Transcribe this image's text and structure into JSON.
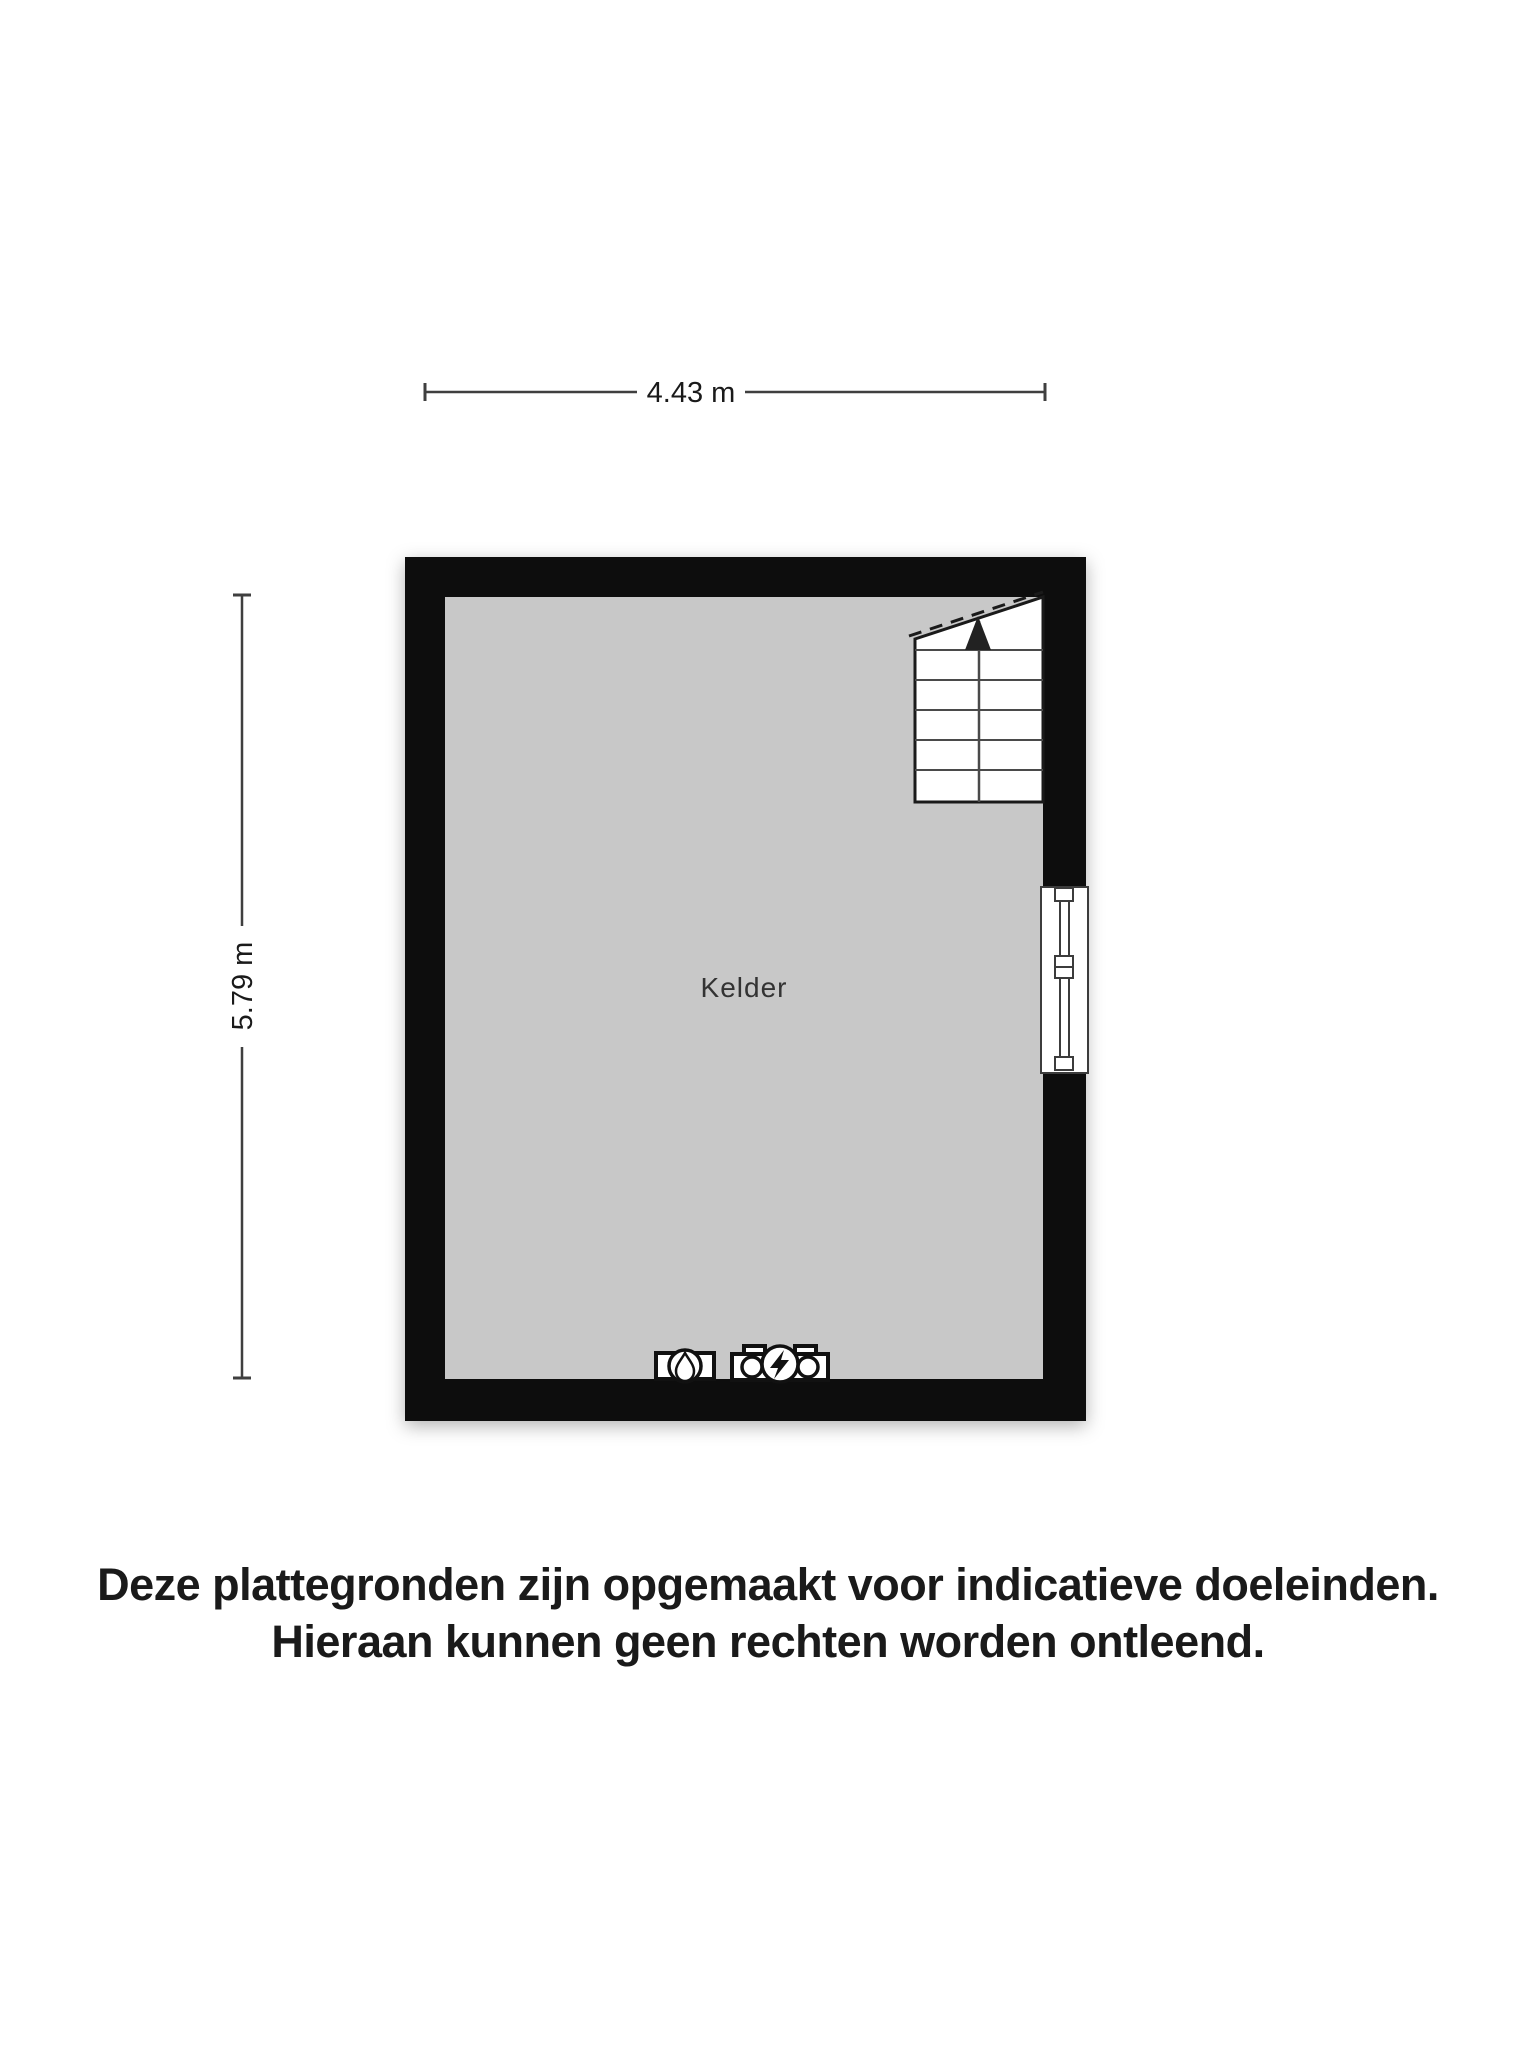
{
  "floorplan": {
    "room": {
      "label": "Kelder"
    },
    "dimensions": {
      "width": {
        "label": "4.43 m"
      },
      "height": {
        "label": "5.79 m"
      }
    },
    "colors": {
      "wall": "#0a0a0a",
      "floor": "#c8c8c8",
      "line": "#3f3f3f",
      "stair_fill": "#ffffff",
      "symbol": "#111111",
      "text": "#1a1a1a",
      "room_text": "#333333",
      "background": "#ffffff"
    },
    "icons": {
      "stairs": "stairs-up-arrow-icon",
      "window": "window-symbol",
      "water_meter": "water-meter-icon",
      "electricity_meter": "electricity-meter-icon"
    }
  },
  "disclaimer": {
    "line1": "Deze plattegronden zijn opgemaakt voor indicatieve doeleinden.",
    "line2": "Hieraan kunnen geen rechten worden ontleend."
  }
}
